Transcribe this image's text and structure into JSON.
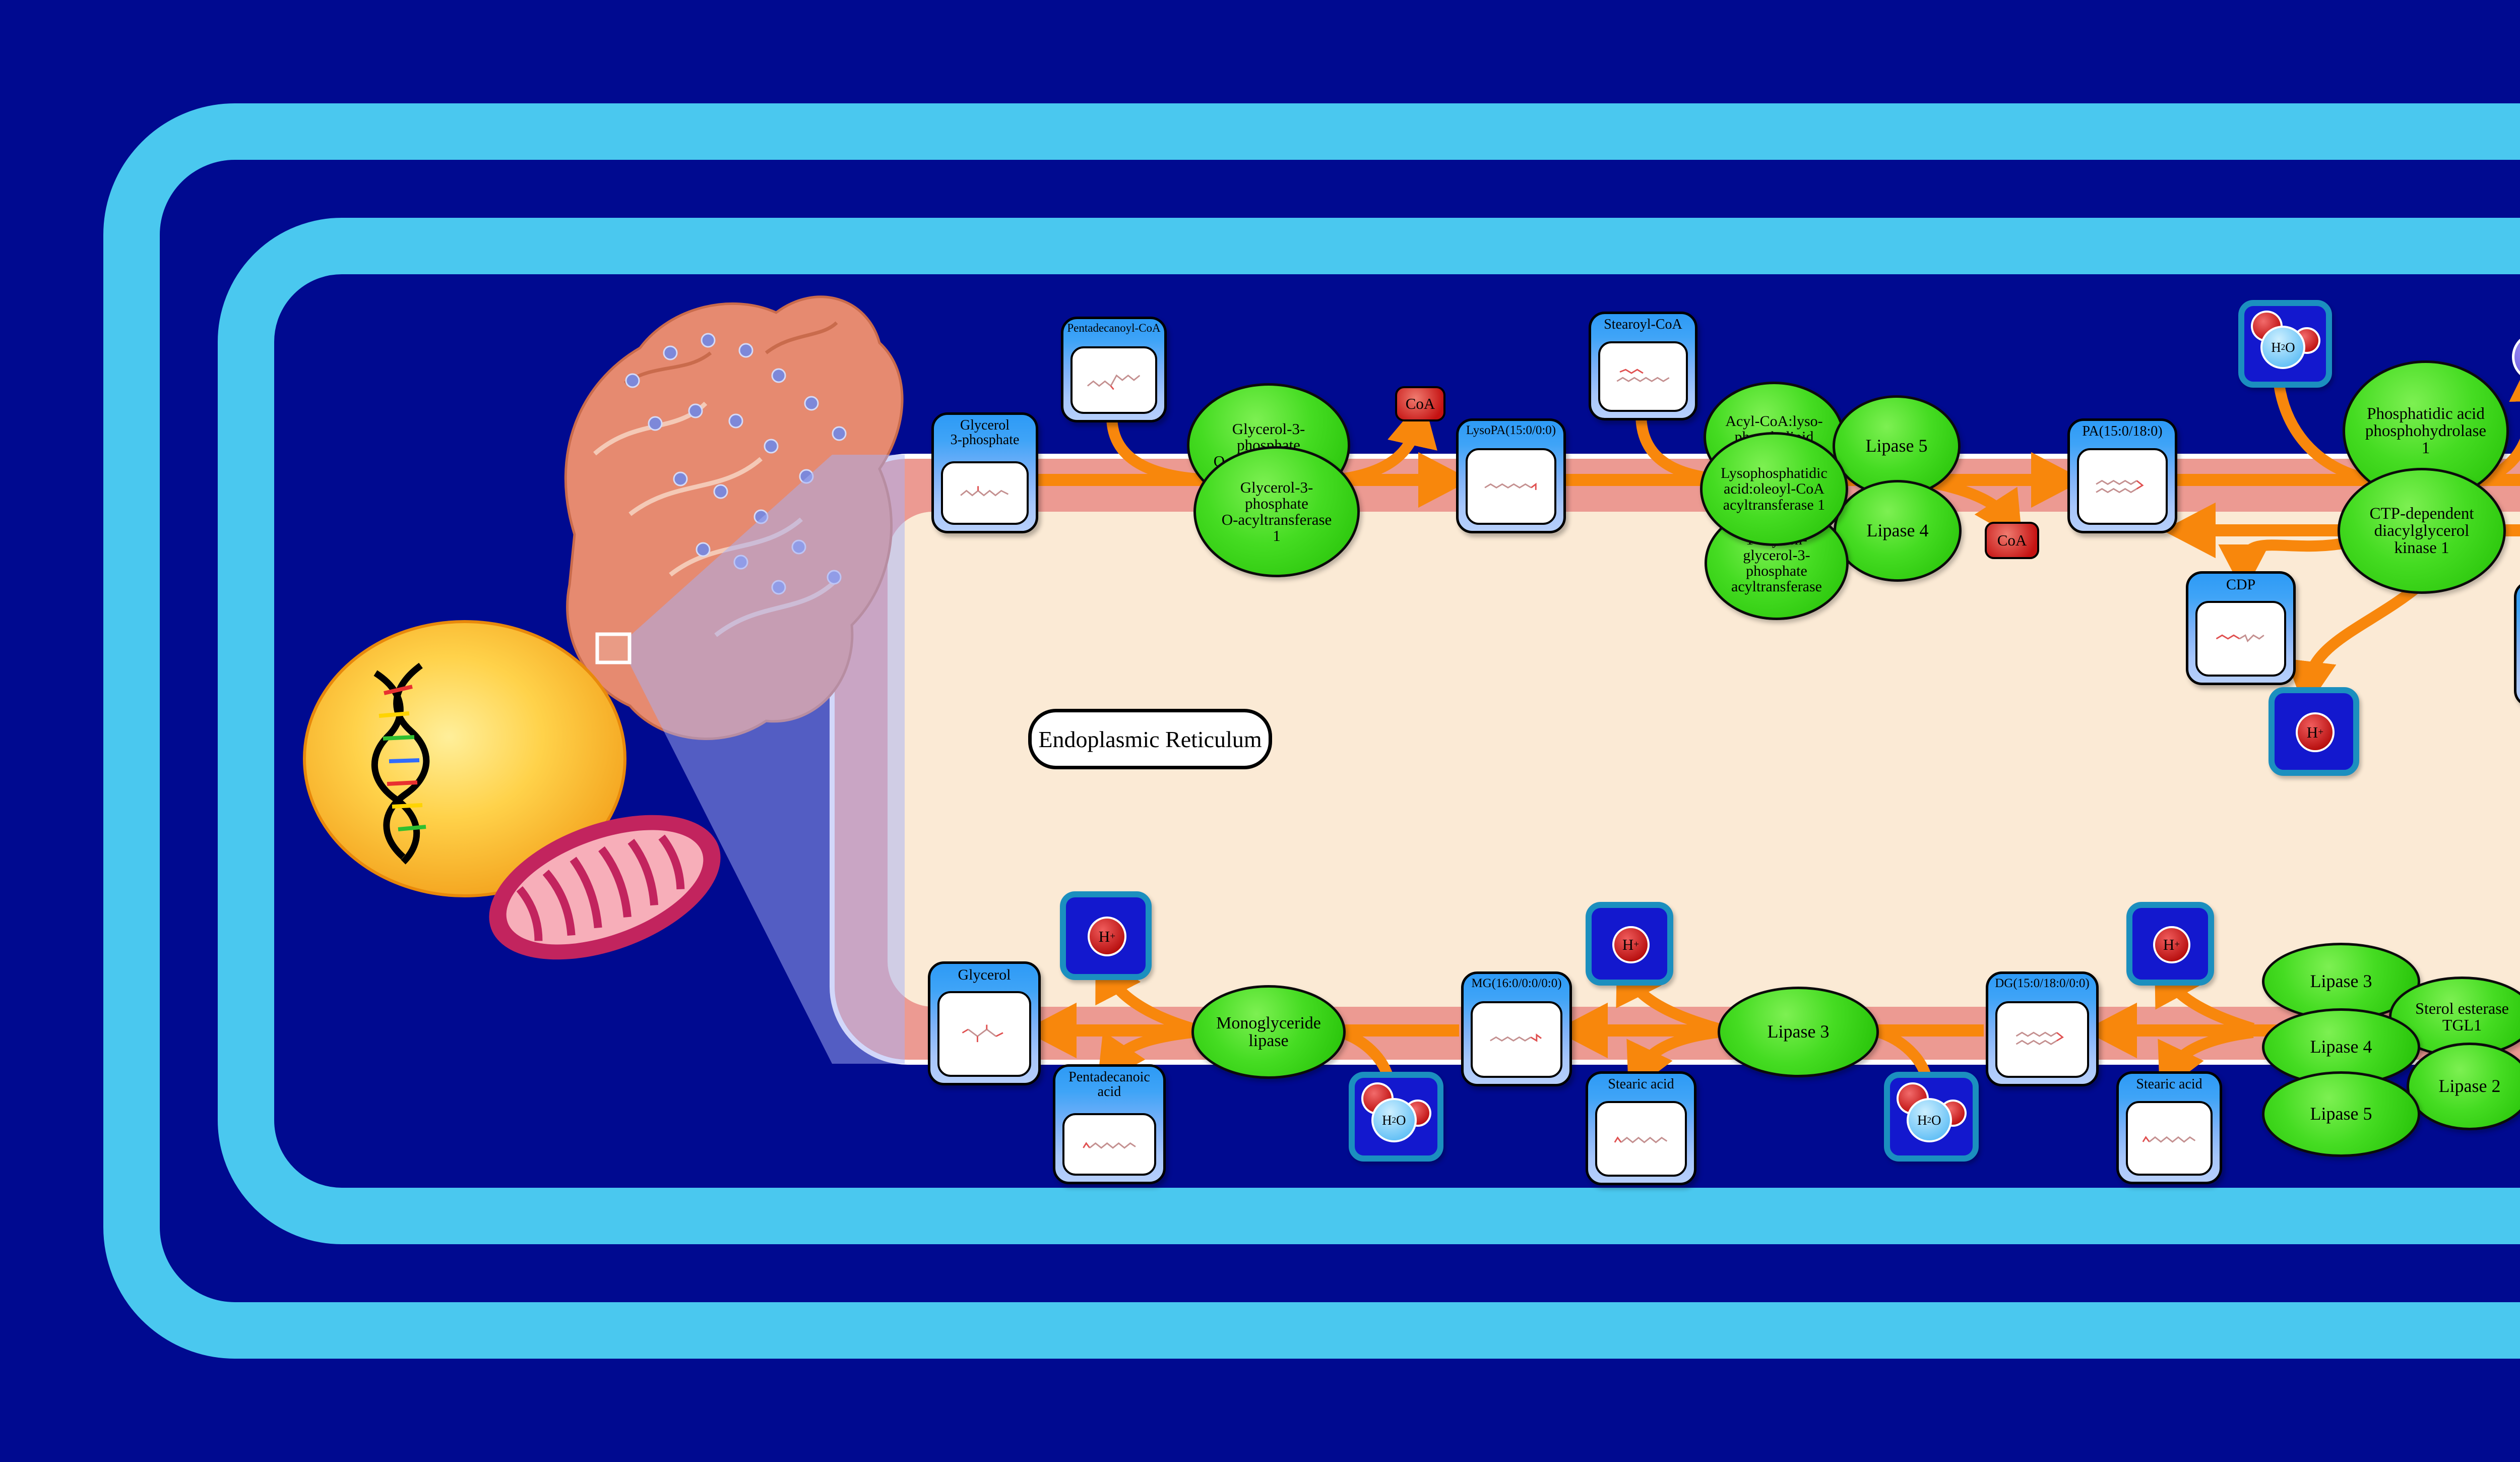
{
  "compartment": {
    "label": "Endoplasmic Reticulum"
  },
  "colors": {
    "background": "#000A90",
    "cell_frame_blue": "#4AC8EF",
    "er_membrane_salmon": "#EC9A92",
    "er_lumen_cream": "#FBEAD5",
    "arrow_orange": "#F8870C",
    "enzyme_green": "#2BC60C",
    "node_header_blue": "#2D9AF6",
    "node_body_blue": "#A7C6FB",
    "cofactor_red": "#C51212",
    "icon_blue_fill": "#1318CE",
    "icon_teal_border": "#1B8FBF",
    "pi_purple": "#6E5DE4",
    "nucleus_yellow": "#F9B51E",
    "mitochondrion_pink": "#C2245E",
    "organelle_salmon": "#E68A70",
    "zoom_beam": "#8A94E8"
  },
  "metabolites": {
    "glycerol_3_phosphate": "Glycerol\n3-phosphate",
    "pentadecanoyl_coa": "Pentadecanoyl-CoA",
    "lysopa": "LysoPA(15:0/0:0)",
    "stearoyl_coa_top": "Stearoyl-CoA",
    "pa": "PA(15:0/18:0)",
    "cdp": "CDP",
    "cytidine_triphosphate": "Cytidine\ntriphosphate",
    "dg_top": "DG(15:0/18:0/0:0)",
    "stearoyl_coa_right": "Stearoyl-CoA",
    "tg": "TG(15:0/18:0/18:0)",
    "dg_bottom": "DG(15:0/18:0/0:0)",
    "stearic_acid_right": "Stearic acid",
    "stearic_acid_left": "Stearic acid",
    "mg": "MG(16:0/0:0/0:0)",
    "pentadecanoic_acid": "Pentadecanoic\nacid",
    "glycerol": "Glycerol"
  },
  "enzymes": {
    "gpat": "Glycerol-3-\nphosphate\nO-acyltransferase",
    "gpat1": "Glycerol-3-\nphosphate\nO-acyltransferase\n1",
    "acyl_coa_lysophospholipid_acyltransferase": "Acyl-CoA:lyso-\nphospholipid\nacyltransferase",
    "lipase5_top": "Lipase 5",
    "lysophosphatidic_acyltransferase1": "Lysophosphatidic\nacid:oleoyl-CoA\nacyltransferase 1",
    "lipase4_top": "Lipase 4",
    "agpat": "1-acyl-sn-\nglycerol-3-\nphosphate\nacyltransferase",
    "phosphatidic_acid_phosphohydrolase1": "Phosphatidic acid\nphosphohydrolase\n1",
    "ctp_dependent_dag_kinase1": "CTP-dependent\ndiacylglycerol\nkinase 1",
    "dgat1": "Diacylglycerol\nO-acyltransferase\n1",
    "lipase3_cluster": "Lipase 3",
    "sterol_esterase_tgl1": "Sterol esterase\nTGL1",
    "lipase4_cluster": "Lipase 4",
    "lipase2_cluster": "Lipase 2",
    "lipase5_cluster": "Lipase 5",
    "lipase3": "Lipase 3",
    "monoglyceride_lipase": "Monoglyceride\nlipase"
  },
  "cofactors": {
    "coa": "CoA",
    "h2o": {
      "h": "H",
      "sub": "2",
      "o": "O"
    },
    "h_plus": {
      "h": "H",
      "sup": "+"
    },
    "pi": {
      "p": "P",
      "sub": "i"
    }
  }
}
